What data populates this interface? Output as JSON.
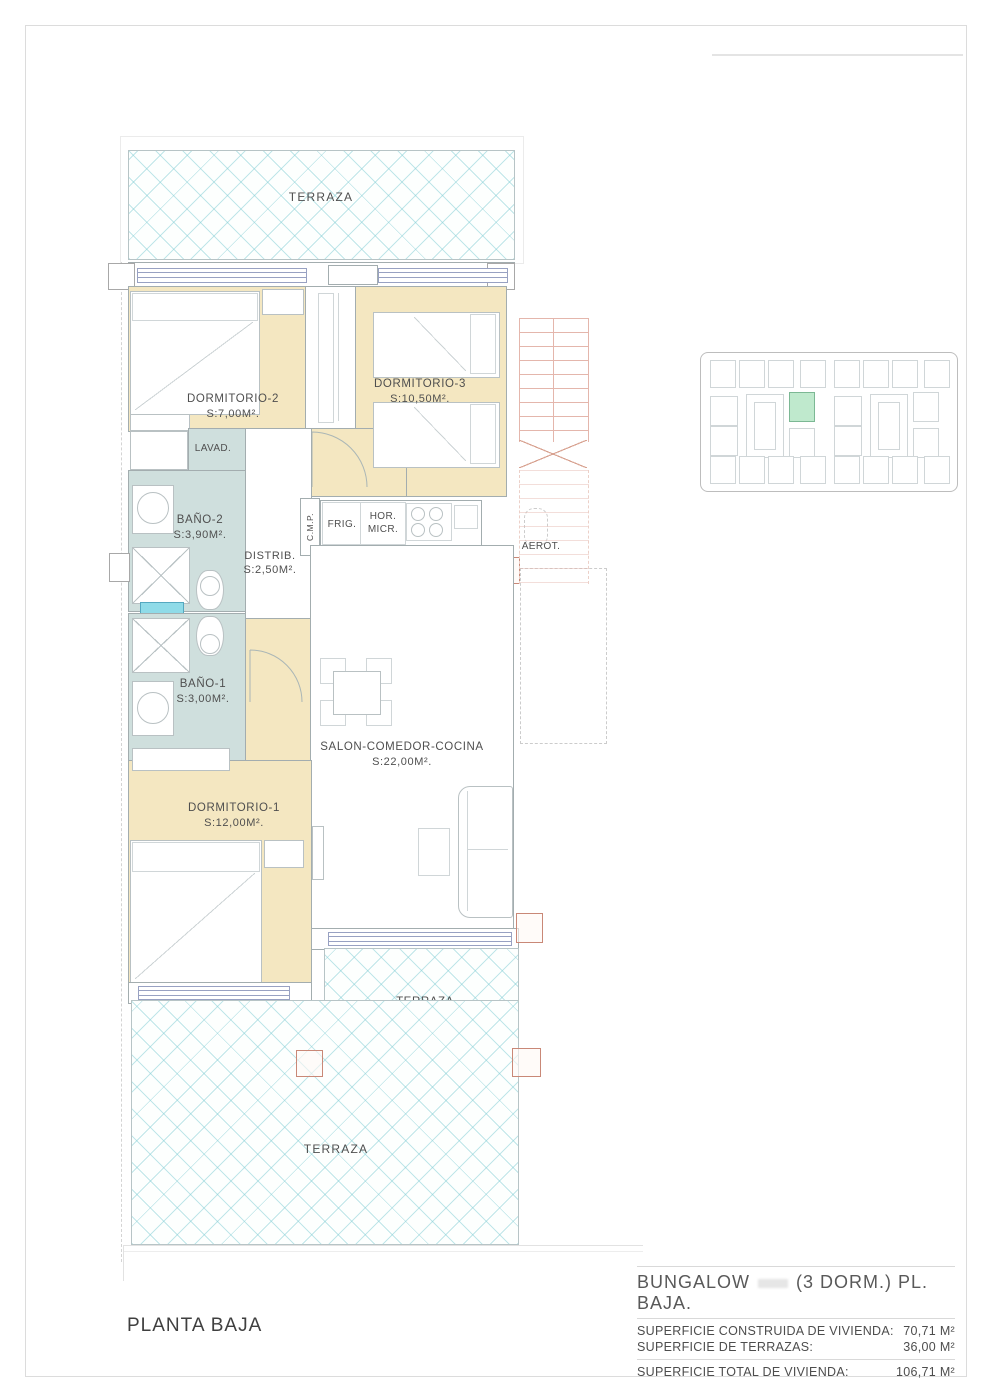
{
  "footer": {
    "plan_title": "PLANTA BAJA"
  },
  "title_block": {
    "title_prefix": "BUNGALOW",
    "title_suffix": "(3 DORM.)  PL. BAJA.",
    "rows": [
      {
        "label": "SUPERFICIE CONSTRUIDA DE VIVIENDA:",
        "value": "70,71 M²"
      },
      {
        "label": "SUPERFICIE DE TERRAZAS:",
        "value": "36,00 M²"
      }
    ],
    "total_row": {
      "label": "SUPERFICIE TOTAL DE VIVIENDA:",
      "value": "106,71 M²"
    }
  },
  "rooms": {
    "terraza_top": {
      "name": "TERRAZA"
    },
    "dormitorio2": {
      "name": "DORMITORIO-2",
      "area": "S:7,00M²."
    },
    "dormitorio3": {
      "name": "DORMITORIO-3",
      "area": "S:10,50M²."
    },
    "lavadero": {
      "name": "LAVAD."
    },
    "bano2": {
      "name": "BAÑO-2",
      "area": "S:3,90M²."
    },
    "distribuidor": {
      "name": "DISTRIB.",
      "area": "S:2,50M²."
    },
    "bano1": {
      "name": "BAÑO-1",
      "area": "S:3,00M²."
    },
    "dormitorio1": {
      "name": "DORMITORIO-1",
      "area": "S:12,00M²."
    },
    "salon": {
      "name": "SALON-COMEDOR-COCINA",
      "area": "S:22,00M²."
    },
    "terraza_small": {
      "name": "TERRAZA",
      "area": "S:7,00M²."
    },
    "terraza_bottom": {
      "name": "TERRAZA"
    }
  },
  "kitchen": {
    "cmp": "C.M.P.",
    "frigorifico": "FRIG.",
    "horno_line1": "HOR.",
    "horno_line2": "MICR.",
    "aerotermia": "AEROT.",
    "lavavajillas": "LAVAV."
  },
  "colors": {
    "bedroom_fill": "#f4e7c1",
    "bathroom_fill": "#cfdfdd",
    "terrace_hatch_line": "#82cdd4",
    "window_line": "#98a1c2",
    "stair_line": "#e4b6ac",
    "pillar_red": "#c98877",
    "site_highlight": "#bfe9cd",
    "text": "#4f4f4f"
  }
}
